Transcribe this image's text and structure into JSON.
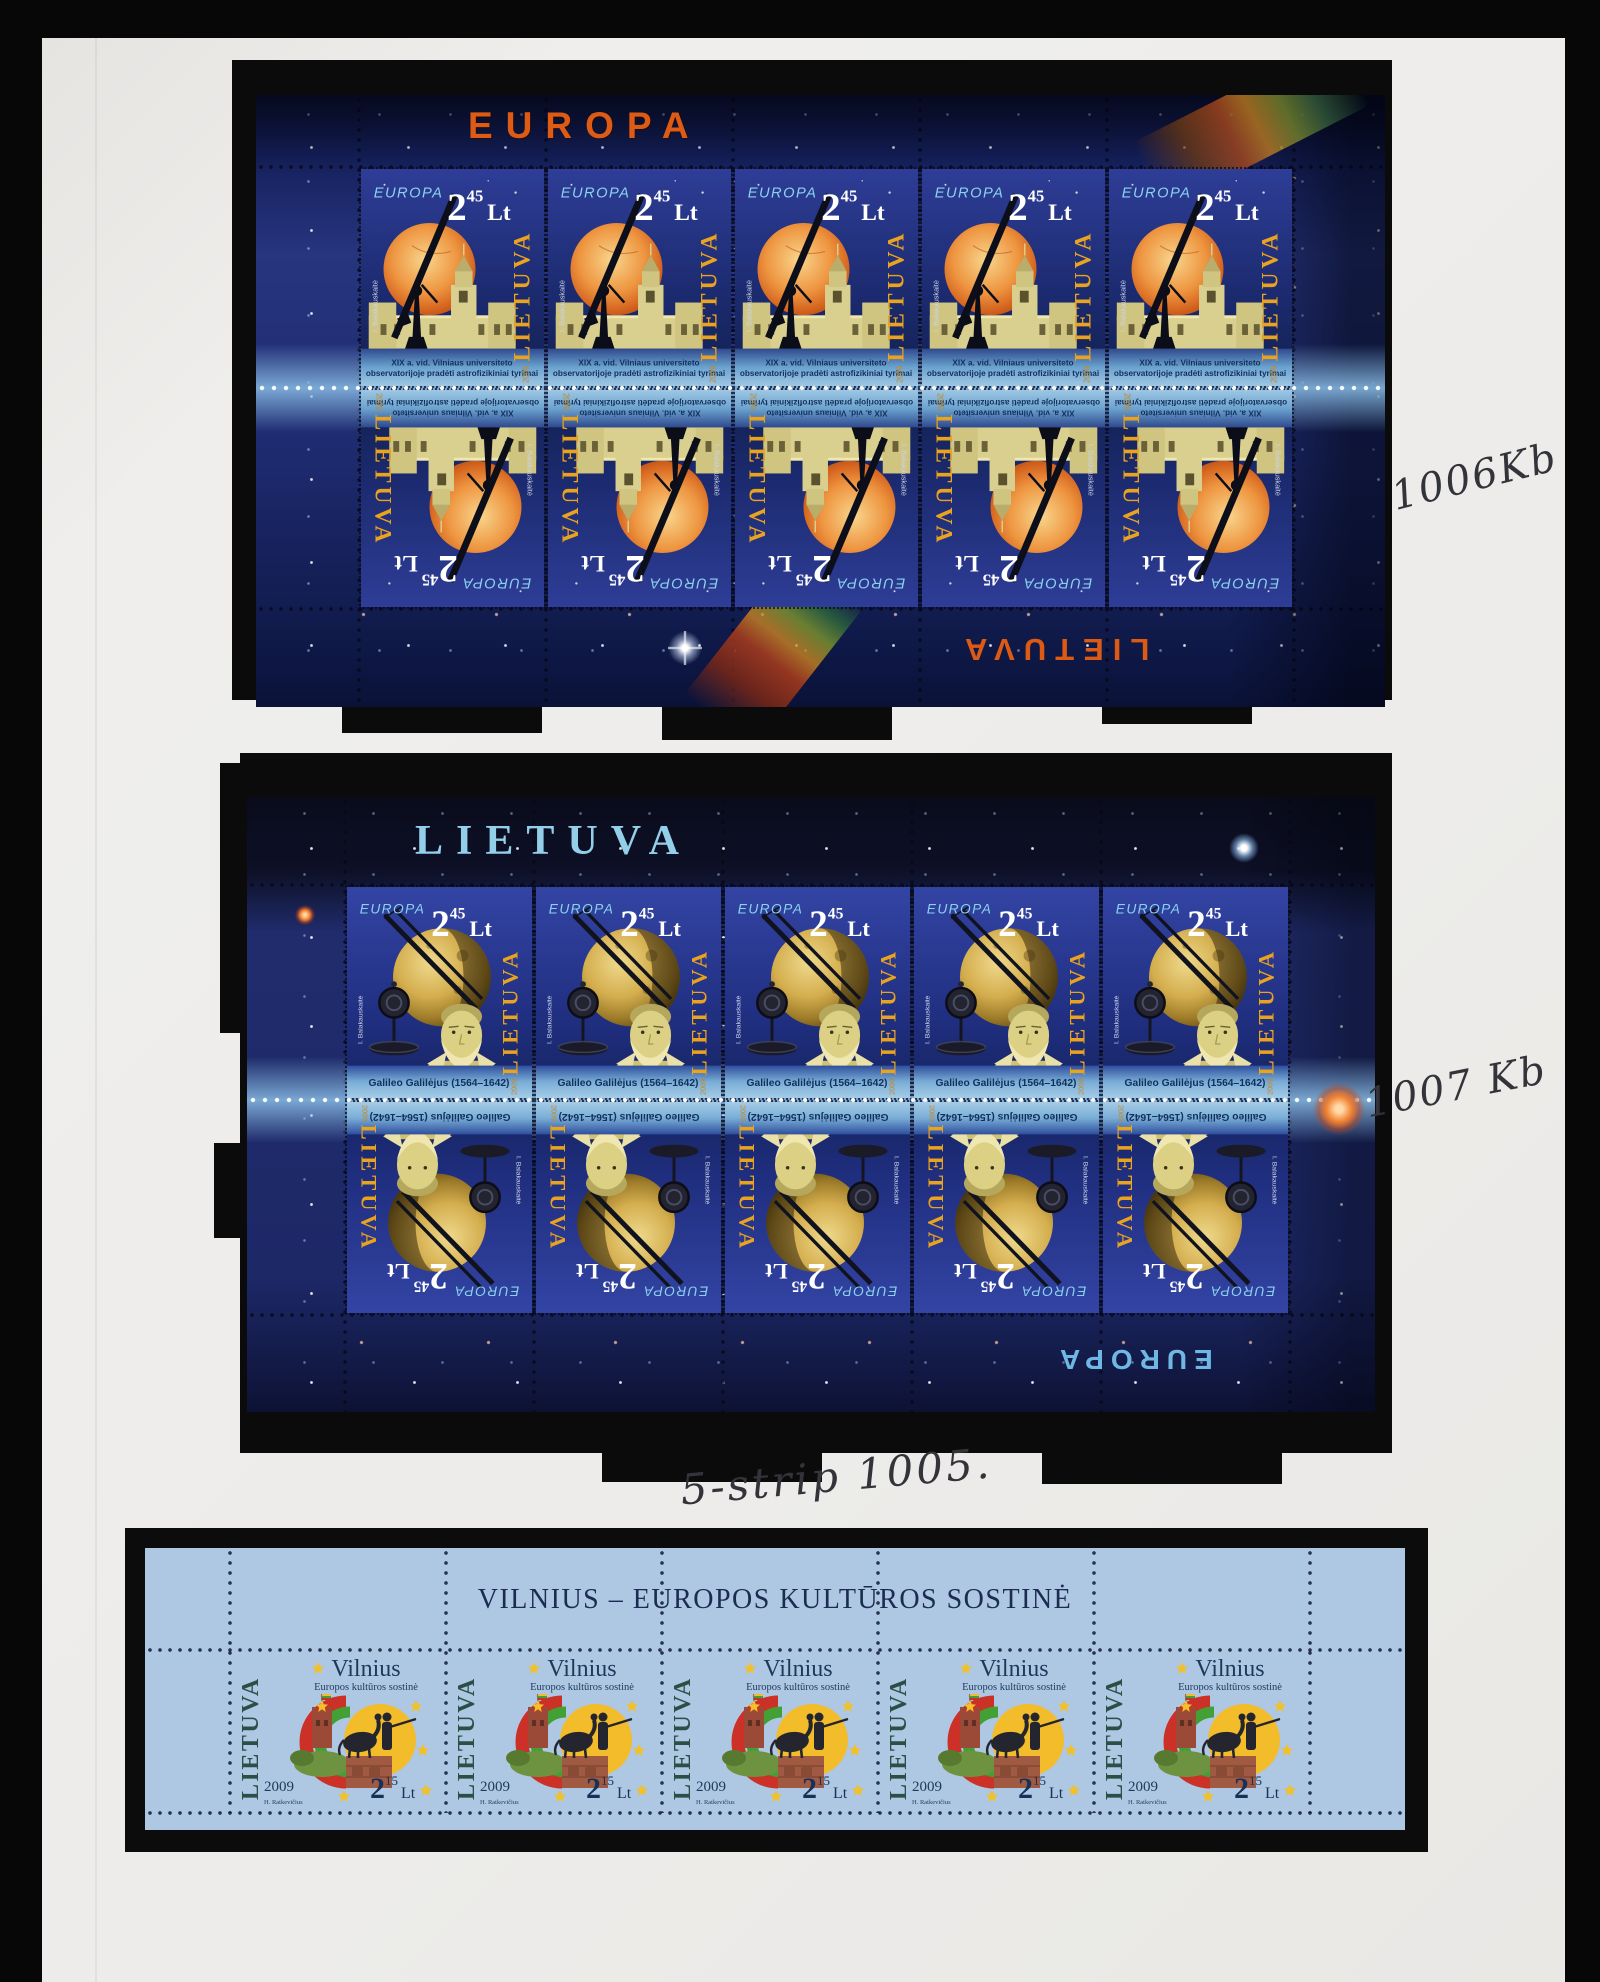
{
  "annotations": {
    "note_top": "1006Kb",
    "note_middle": "1007 Kb",
    "note_strip": "5-strip 1005."
  },
  "europa_sheet": {
    "margin_title": "EUROPA",
    "margin_title_bottom": "LIETUVA",
    "cols": 5,
    "stamp": {
      "logo": "EUROPA",
      "denom": "2",
      "denom_sup": "45",
      "currency": "Lt",
      "country": "LIETUVA",
      "year": "2009",
      "designer": "I. Balakauskaitė",
      "caption1": "XIX a. vid. Vilniaus universiteto",
      "caption2": "observatorijoje pradėti astrofizikiniai tyrimai"
    }
  },
  "galileo_sheet": {
    "margin_title": "LIETUVA",
    "margin_title_bottom": "EUROPA",
    "cols": 5,
    "stamp": {
      "logo": "EUROPA",
      "denom": "2",
      "denom_sup": "45",
      "currency": "Lt",
      "country": "LIETUVA",
      "year": "2009",
      "designer": "I. Balakauskaitė",
      "caption": "Galileo Galilėjus (1564–1642)"
    }
  },
  "vilnius_strip": {
    "header": "VILNIUS – EUROPOS KULTŪROS SOSTINĖ",
    "count": 5,
    "stamp": {
      "country": "LIETUVA",
      "title": "Vilnius",
      "subtitle": "Europos kultūros sostinė",
      "year": "2009",
      "designer": "H. Ratkevičius",
      "denom": "2",
      "denom_sup": "15",
      "currency": "Lt"
    }
  },
  "colors": {
    "europa_title_orange": "#dd5b15",
    "logo_light_blue": "#8ad2ee",
    "country_orange": "#eaa31e",
    "caption_navy": "#12305c",
    "strip_blue": "#aec7e2",
    "strip_navy": "#1c2b52",
    "strip_green": "#2a4f46",
    "flag_red": "#cb3126",
    "flag_green": "#42a035",
    "flag_yellow": "#f2bc2b",
    "star_yellow": "#f2c027"
  }
}
